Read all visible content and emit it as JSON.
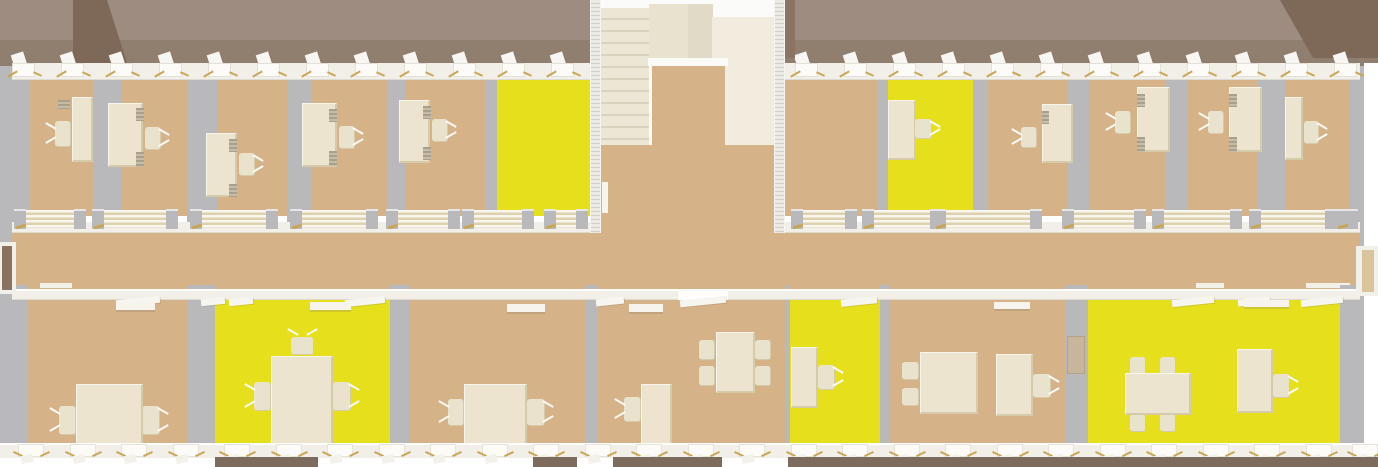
{
  "scene": {
    "description": "3D top-down rendering of an office building floor plan with two rows of offices, a central stairwell, a middle corridor, highlighted (yellow) rooms and cream furniture",
    "canvas": {
      "w": 1378,
      "h": 467
    },
    "palette": {
      "background": "#ffffff",
      "roof_light": "#9e8c80",
      "roof_dark": "#907e6f",
      "gable_dark": "#7e6958",
      "floor_tan": "#d6b288",
      "floor_highlight_yellow": "#e6e01c",
      "wall_gray": "#b9b9bb",
      "wall_white": "#f2efe8",
      "furniture_cream": "#ece4ce",
      "furniture_edge": "#d5cbab",
      "door_stripe": "#ddd2ad",
      "stair_cream": "#ece6d4",
      "stair_tread": "#d9d2bd",
      "landing_cream": "#f1ecdd",
      "ground_dark": "#7d6c5e",
      "gold_accent": "#c9a557",
      "door_leaf_brown": "#8a7263",
      "door_leaf_tan": "#d9c49c"
    },
    "roof": {
      "y": 0,
      "h": 66,
      "split": 40,
      "gable_left": "polygon(73px 0, 107px 0, 128px 66px, 73px 66px)",
      "gable_right": "polygon(1280px 0, 1378px 0, 1378px 58px, 1313px 58px)"
    },
    "exterior": {
      "top_wall": {
        "x": 12,
        "y": 63,
        "w": 1348,
        "h": 17
      },
      "bottom_wall": {
        "x": 0,
        "y": 443,
        "w": 1378,
        "h": 15
      },
      "left_wall": {
        "x": 0,
        "y": 66,
        "w": 12,
        "h": 377
      },
      "right_wall": {
        "x": 1348,
        "y": 66,
        "w": 16,
        "h": 377
      },
      "left_door": {
        "frame": [
          0,
          242,
          16,
          52
        ],
        "leaf": [
          2,
          246,
          10,
          44
        ]
      },
      "right_door": {
        "frame": [
          1356,
          246,
          22,
          50
        ],
        "leaf": [
          1362,
          250,
          12,
          42
        ]
      },
      "ground_segments": [
        [
          215,
          103
        ],
        [
          533,
          44
        ],
        [
          613,
          109
        ],
        [
          788,
          590
        ]
      ]
    },
    "corridor": {
      "x": 12,
      "y": 233,
      "w": 1348,
      "h": 56,
      "top_wall_segments": [
        [
          12,
          578
        ],
        [
          785,
          575
        ]
      ],
      "top_wall_y": 222,
      "top_wall_h": 11,
      "bottom_wall_segments": [
        [
          12,
          666
        ],
        [
          728,
          632
        ]
      ],
      "bottom_wall_y": 289,
      "bottom_wall_h": 11,
      "door_stacks_y": 210,
      "door_stacks": [
        [
          14,
          72
        ],
        [
          92,
          86
        ],
        [
          190,
          88
        ],
        [
          290,
          88
        ],
        [
          386,
          74
        ],
        [
          462,
          72
        ],
        [
          544,
          44
        ],
        [
          791,
          66
        ],
        [
          862,
          80
        ],
        [
          934,
          108
        ],
        [
          1062,
          84
        ],
        [
          1152,
          90
        ],
        [
          1249,
          88
        ],
        [
          1336,
          22
        ]
      ],
      "corridor_slabs": [
        [
          40,
          32
        ],
        [
          1196,
          28
        ],
        [
          1306,
          44
        ]
      ],
      "room_door_flaps": [
        [
          116,
          44
        ],
        [
          201,
          24
        ],
        [
          229,
          24
        ],
        [
          345,
          40
        ],
        [
          596,
          28
        ],
        [
          680,
          46
        ],
        [
          841,
          36
        ],
        [
          1172,
          42
        ],
        [
          1238,
          32
        ],
        [
          1301,
          42
        ]
      ]
    },
    "rooms_top": {
      "floor_y": 78,
      "floor_h": 138,
      "wall_y": 66,
      "wall_h": 156,
      "bounds_left": [
        12,
        590
      ],
      "bounds_right": [
        785,
        1360
      ],
      "list": [
        {
          "id": "office-t1",
          "x": 30,
          "w": 63,
          "floor": "tan"
        },
        {
          "id": "office-t2",
          "x": 122,
          "w": 65,
          "floor": "tan"
        },
        {
          "id": "office-t3",
          "x": 217,
          "w": 70,
          "floor": "tan"
        },
        {
          "id": "office-t4",
          "x": 312,
          "w": 75,
          "floor": "tan"
        },
        {
          "id": "office-t5",
          "x": 405,
          "w": 80,
          "floor": "tan"
        },
        {
          "id": "office-t6-highlighted",
          "x": 497,
          "w": 93,
          "floor": "yellow"
        },
        {
          "id": "office-t7",
          "x": 785,
          "w": 92,
          "floor": "tan"
        },
        {
          "id": "office-t8-highlighted",
          "x": 888,
          "w": 85,
          "floor": "yellow"
        },
        {
          "id": "office-t9",
          "x": 988,
          "w": 80,
          "floor": "tan"
        },
        {
          "id": "office-t10",
          "x": 1090,
          "w": 75,
          "floor": "tan"
        },
        {
          "id": "office-t11",
          "x": 1187,
          "w": 70,
          "floor": "tan"
        },
        {
          "id": "office-t12",
          "x": 1285,
          "w": 65,
          "floor": "tan"
        }
      ]
    },
    "rooms_bottom": {
      "floor_y": 300,
      "floor_h": 143,
      "wall_y": 285,
      "wall_h": 160,
      "bounds": [
        12,
        1360
      ],
      "list": [
        {
          "id": "office-b1",
          "x": 28,
          "w": 160,
          "floor": "tan"
        },
        {
          "id": "meeting-b2-highlighted",
          "x": 215,
          "w": 175,
          "floor": "yellow"
        },
        {
          "id": "office-b3",
          "x": 410,
          "w": 175,
          "floor": "tan"
        },
        {
          "id": "office-b4",
          "x": 598,
          "w": 187,
          "floor": "tan"
        },
        {
          "id": "office-b5-highlighted",
          "x": 790,
          "w": 90,
          "floor": "yellow"
        },
        {
          "id": "office-b6",
          "x": 890,
          "w": 175,
          "floor": "tan"
        },
        {
          "id": "meeting-b7-highlighted",
          "x": 1088,
          "w": 252,
          "floor": "yellow"
        }
      ]
    },
    "stairwell": {
      "block": [
        590,
        0,
        195,
        233
      ],
      "left_wall": [
        590,
        0,
        11,
        233
      ],
      "right_wall": [
        774,
        0,
        11,
        233
      ],
      "stairs": [
        601,
        8,
        48,
        137
      ],
      "top_block": [
        649,
        4,
        64,
        55
      ],
      "top_block2": [
        688,
        4,
        25,
        57
      ],
      "landing": [
        712,
        17,
        62,
        128
      ],
      "edge": [
        648,
        58,
        80,
        8
      ],
      "opening": [
        652,
        66,
        73,
        79
      ],
      "lobby": [
        601,
        145,
        173,
        88
      ],
      "wall_slab": [
        602,
        182,
        6,
        31
      ],
      "dark_corner": [
        785,
        0,
        10,
        58
      ]
    },
    "windows_top": [
      12,
      61,
      110,
      159,
      208,
      257,
      306,
      355,
      404,
      453,
      502,
      551,
      795,
      844,
      893,
      942,
      991,
      1040,
      1089,
      1138,
      1187,
      1236,
      1285,
      1334
    ],
    "windows_bottom": [
      18,
      70,
      121,
      173,
      224,
      276,
      327,
      379,
      430,
      482,
      533,
      585,
      636,
      688,
      739,
      791,
      842,
      894,
      945,
      997,
      1048,
      1100,
      1151,
      1203,
      1254,
      1306,
      1352
    ],
    "furniture": [
      {
        "t": "pc",
        "x": 58,
        "y": 100,
        "w": 12,
        "h": 9
      },
      {
        "t": "desk",
        "x": 72,
        "y": 97,
        "w": 21,
        "h": 65
      },
      {
        "t": "chair",
        "x": 55,
        "y": 121,
        "w": 16,
        "h": 26,
        "d": "l"
      },
      {
        "t": "desk",
        "x": 108,
        "y": 103,
        "w": 35,
        "h": 64
      },
      {
        "t": "pc",
        "x": 136,
        "y": 108,
        "w": 8,
        "h": 13
      },
      {
        "t": "pc",
        "x": 136,
        "y": 152,
        "w": 8,
        "h": 15
      },
      {
        "t": "chair",
        "x": 145,
        "y": 127,
        "w": 16,
        "h": 23,
        "d": "r"
      },
      {
        "t": "desk",
        "x": 206,
        "y": 133,
        "w": 31,
        "h": 64
      },
      {
        "t": "pc",
        "x": 229,
        "y": 139,
        "w": 8,
        "h": 13
      },
      {
        "t": "pc",
        "x": 229,
        "y": 184,
        "w": 8,
        "h": 13
      },
      {
        "t": "chair",
        "x": 239,
        "y": 153,
        "w": 16,
        "h": 23,
        "d": "r"
      },
      {
        "t": "desk",
        "x": 302,
        "y": 103,
        "w": 35,
        "h": 64
      },
      {
        "t": "pc",
        "x": 329,
        "y": 109,
        "w": 8,
        "h": 13
      },
      {
        "t": "pc",
        "x": 329,
        "y": 151,
        "w": 8,
        "h": 15
      },
      {
        "t": "chair",
        "x": 339,
        "y": 126,
        "w": 16,
        "h": 23,
        "d": "r"
      },
      {
        "t": "desk",
        "x": 399,
        "y": 100,
        "w": 31,
        "h": 63
      },
      {
        "t": "pc",
        "x": 423,
        "y": 106,
        "w": 8,
        "h": 13
      },
      {
        "t": "pc",
        "x": 423,
        "y": 147,
        "w": 8,
        "h": 13
      },
      {
        "t": "chair",
        "x": 432,
        "y": 119,
        "w": 16,
        "h": 23,
        "d": "r"
      },
      {
        "t": "desk",
        "x": 888,
        "y": 100,
        "w": 28,
        "h": 60
      },
      {
        "t": "chair",
        "x": 915,
        "y": 119,
        "w": 17,
        "h": 20,
        "d": "r"
      },
      {
        "t": "desk",
        "x": 1042,
        "y": 104,
        "w": 31,
        "h": 59
      },
      {
        "t": "pc",
        "x": 1042,
        "y": 111,
        "w": 7,
        "h": 13
      },
      {
        "t": "chair",
        "x": 1021,
        "y": 127,
        "w": 16,
        "h": 21,
        "d": "l"
      },
      {
        "t": "desk",
        "x": 1137,
        "y": 87,
        "w": 33,
        "h": 65
      },
      {
        "t": "pc",
        "x": 1137,
        "y": 94,
        "w": 8,
        "h": 13
      },
      {
        "t": "pc",
        "x": 1137,
        "y": 137,
        "w": 8,
        "h": 15
      },
      {
        "t": "chair",
        "x": 1115,
        "y": 111,
        "w": 16,
        "h": 23,
        "d": "l"
      },
      {
        "t": "desk",
        "x": 1229,
        "y": 87,
        "w": 33,
        "h": 65
      },
      {
        "t": "pc",
        "x": 1229,
        "y": 94,
        "w": 8,
        "h": 13
      },
      {
        "t": "pc",
        "x": 1229,
        "y": 137,
        "w": 8,
        "h": 15
      },
      {
        "t": "chair",
        "x": 1208,
        "y": 111,
        "w": 16,
        "h": 23,
        "d": "l"
      },
      {
        "t": "desk",
        "x": 1285,
        "y": 97,
        "w": 18,
        "h": 63
      },
      {
        "t": "chair",
        "x": 1304,
        "y": 121,
        "w": 15,
        "h": 23,
        "d": "r"
      },
      {
        "t": "chair",
        "x": 59,
        "y": 406,
        "w": 17,
        "h": 29,
        "d": "l"
      },
      {
        "t": "chair",
        "x": 142,
        "y": 406,
        "w": 18,
        "h": 29,
        "d": "r"
      },
      {
        "t": "table",
        "x": 76,
        "y": 384,
        "w": 67,
        "h": 62
      },
      {
        "t": "shelf",
        "x": 116,
        "y": 302,
        "w": 39,
        "h": 8
      },
      {
        "t": "chair",
        "x": 254,
        "y": 382,
        "w": 17,
        "h": 29,
        "d": "l"
      },
      {
        "t": "chair",
        "x": 333,
        "y": 382,
        "w": 18,
        "h": 29,
        "d": "r"
      },
      {
        "t": "chair",
        "x": 291,
        "y": 337,
        "w": 23,
        "h": 18,
        "d": "t"
      },
      {
        "t": "table",
        "x": 271,
        "y": 356,
        "w": 62,
        "h": 92
      },
      {
        "t": "shelf",
        "x": 310,
        "y": 302,
        "w": 41,
        "h": 8
      },
      {
        "t": "chair",
        "x": 448,
        "y": 399,
        "w": 16,
        "h": 27,
        "d": "l"
      },
      {
        "t": "chair",
        "x": 527,
        "y": 399,
        "w": 18,
        "h": 27,
        "d": "r"
      },
      {
        "t": "table",
        "x": 464,
        "y": 384,
        "w": 63,
        "h": 62
      },
      {
        "t": "shelf",
        "x": 507,
        "y": 304,
        "w": 38,
        "h": 8
      },
      {
        "t": "chair",
        "x": 624,
        "y": 397,
        "w": 17,
        "h": 25,
        "d": "l"
      },
      {
        "t": "desk",
        "x": 641,
        "y": 384,
        "w": 31,
        "h": 65
      },
      {
        "t": "chair4",
        "x": 699,
        "y": 340,
        "w": 16,
        "h": 20
      },
      {
        "t": "chair4",
        "x": 699,
        "y": 366,
        "w": 16,
        "h": 20
      },
      {
        "t": "chair4",
        "x": 755,
        "y": 340,
        "w": 16,
        "h": 20
      },
      {
        "t": "chair4",
        "x": 755,
        "y": 366,
        "w": 16,
        "h": 20
      },
      {
        "t": "table",
        "x": 716,
        "y": 332,
        "w": 39,
        "h": 61
      },
      {
        "t": "shelf",
        "x": 629,
        "y": 304,
        "w": 34,
        "h": 8
      },
      {
        "t": "desk",
        "x": 791,
        "y": 347,
        "w": 27,
        "h": 61
      },
      {
        "t": "chair",
        "x": 818,
        "y": 365,
        "w": 17,
        "h": 25,
        "d": "r"
      },
      {
        "t": "chair4",
        "x": 902,
        "y": 362,
        "w": 17,
        "h": 18
      },
      {
        "t": "chair4",
        "x": 902,
        "y": 388,
        "w": 17,
        "h": 18
      },
      {
        "t": "chair4",
        "x": 961,
        "y": 362,
        "w": 17,
        "h": 18
      },
      {
        "t": "chair4",
        "x": 961,
        "y": 388,
        "w": 17,
        "h": 18
      },
      {
        "t": "table",
        "x": 920,
        "y": 352,
        "w": 58,
        "h": 62
      },
      {
        "t": "desk",
        "x": 996,
        "y": 354,
        "w": 37,
        "h": 62
      },
      {
        "t": "chair",
        "x": 1033,
        "y": 374,
        "w": 18,
        "h": 24,
        "d": "r"
      },
      {
        "t": "shelf",
        "x": 994,
        "y": 302,
        "w": 36,
        "h": 7
      },
      {
        "t": "cabinet",
        "x": 1067,
        "y": 336,
        "w": 18,
        "h": 38
      },
      {
        "t": "chair4",
        "x": 1130,
        "y": 357,
        "w": 16,
        "h": 18
      },
      {
        "t": "chair4",
        "x": 1160,
        "y": 357,
        "w": 16,
        "h": 18
      },
      {
        "t": "chair4",
        "x": 1130,
        "y": 414,
        "w": 16,
        "h": 18
      },
      {
        "t": "chair4",
        "x": 1160,
        "y": 414,
        "w": 16,
        "h": 18
      },
      {
        "t": "table",
        "x": 1125,
        "y": 373,
        "w": 66,
        "h": 42
      },
      {
        "t": "desk",
        "x": 1237,
        "y": 349,
        "w": 36,
        "h": 64
      },
      {
        "t": "chair",
        "x": 1273,
        "y": 374,
        "w": 17,
        "h": 24,
        "d": "r"
      },
      {
        "t": "shelf",
        "x": 1244,
        "y": 300,
        "w": 45,
        "h": 7
      }
    ]
  }
}
